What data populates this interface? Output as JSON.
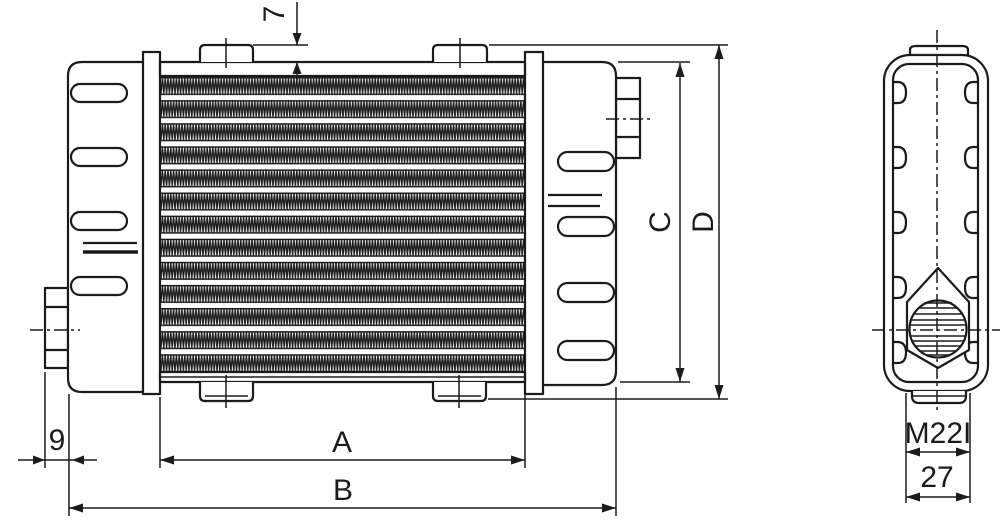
{
  "drawing": {
    "labels": {
      "top_offset": "7",
      "left_offset": "9",
      "core_width": "A",
      "overall_width": "B",
      "tank_height": "C",
      "overall_height": "D",
      "thread_spec": "M22I",
      "hex_width": "27"
    },
    "colors": {
      "line": "#1b1b1b",
      "background": "#ffffff"
    }
  }
}
